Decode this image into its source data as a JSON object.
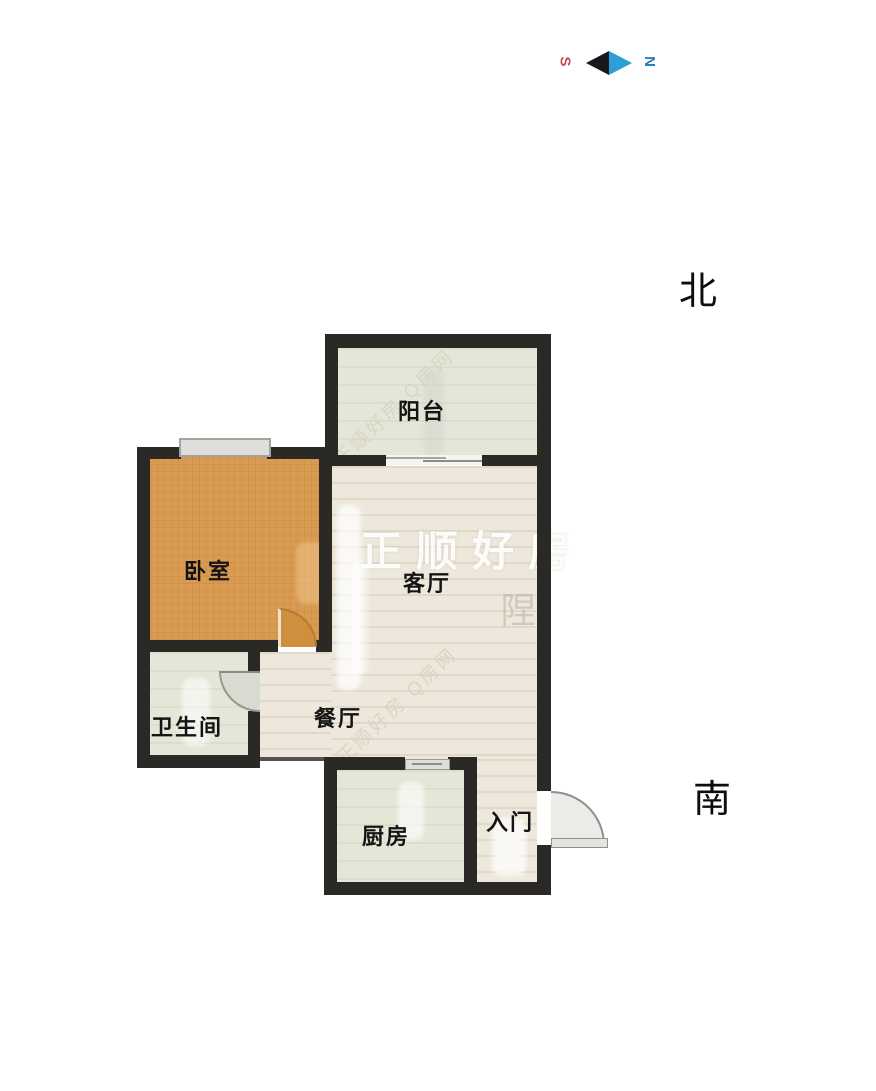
{
  "plan_title": "apartment-floor-plan",
  "orientation": {
    "north_label": "北",
    "south_label": "南"
  },
  "compass": {
    "left_glyph": "S",
    "right_glyph": "N",
    "left_glyph_color": "#c0504d",
    "right_glyph_color": "#2b7fb5",
    "arrow_left_color": "#17191d",
    "arrow_right_color": "#2b9fd6"
  },
  "rooms": {
    "balcony": {
      "label": "阳台"
    },
    "bedroom": {
      "label": "卧室"
    },
    "living": {
      "label": "客厅"
    },
    "bathroom": {
      "label": "卫生间"
    },
    "dining": {
      "label": "餐厅"
    },
    "kitchen": {
      "label": "厨房"
    },
    "entry": {
      "label": "入门"
    }
  },
  "watermarks": {
    "diag_top": "正顺好房 Q房网",
    "diag_bottom": "正顺好房 Q房网",
    "big_center": "正顺好房",
    "faint_glyph_living": "陧"
  },
  "colors": {
    "wall": "#2a2925",
    "bedroom_floor": "#d99a51",
    "green_floor": "#e4e7d7",
    "beige_floor": "#ede8db",
    "door_swing_gray": "#d9dbd0",
    "entry_door_gray": "#ebebe8",
    "label_text": "#141414"
  }
}
